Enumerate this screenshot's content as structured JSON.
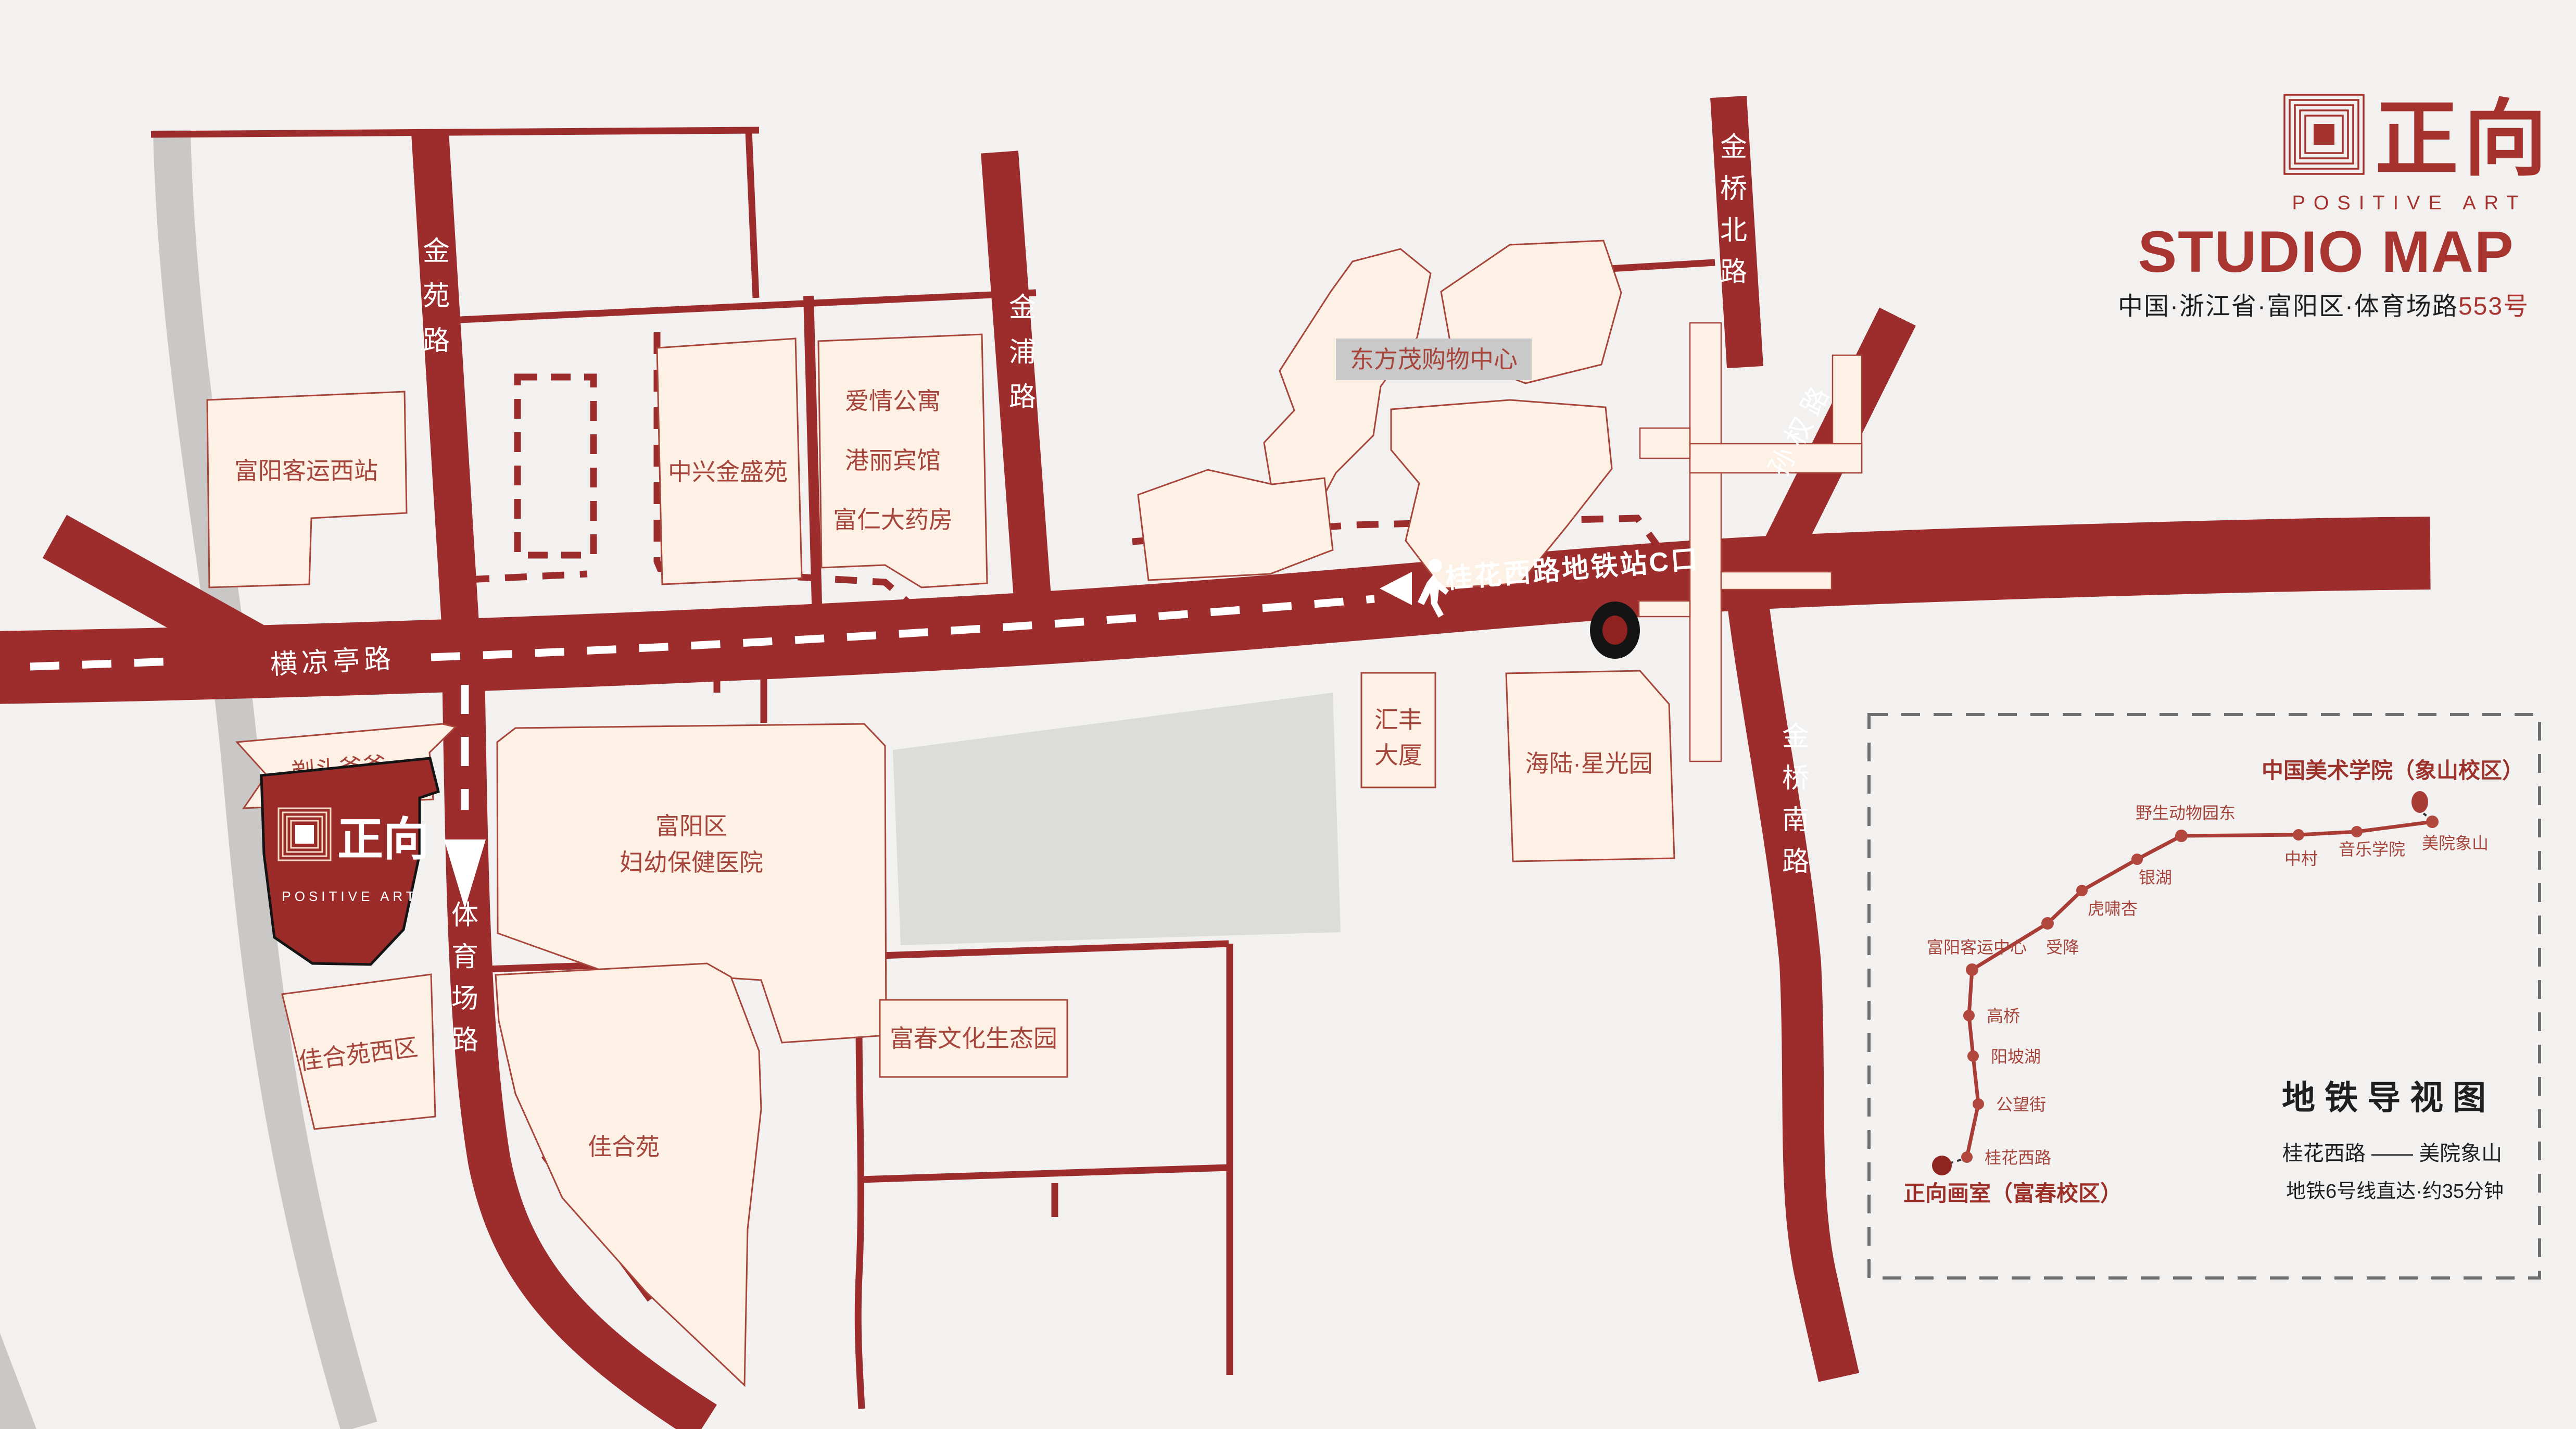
{
  "header": {
    "logo_cn": "正向",
    "logo_en": "POSITIVE ART",
    "title": "STUDIO MAP",
    "address_main": "中国·浙江省·富阳区·体育场路",
    "address_number": "553号"
  },
  "map": {
    "roads": {
      "jinyuan": "金苑路",
      "jinpu": "金浦路",
      "jinqiao_north": "金桥北路",
      "sunquan": "孙权路",
      "jinqiao_south": "金桥南路",
      "hengliangting": "横凉亭路",
      "tiyuchang": "体育场路"
    },
    "metro_exit_label": "桂花西路地铁站C口",
    "buildings": {
      "fuyang_west_station": "富阳客运西站",
      "zhongxing": "中兴金盛苑",
      "aiqing": "爱情公寓",
      "gangli": "港丽宾馆",
      "furen": "富仁大药房",
      "dongfangmao": "东方茂购物中心",
      "huifeng_l1": "汇丰",
      "huifeng_l2": "大厦",
      "hailu": "海陆·星光园",
      "hospital_l1": "富阳区",
      "hospital_l2": "妇幼保健医院",
      "titou": "剃头爸爸",
      "jiaheyuan_west": "佳合苑西区",
      "jiaheyuan": "佳合苑",
      "fuchun_park": "富春文化生态园"
    },
    "studio": {
      "cn": "正向",
      "en": "POSITIVE ART"
    }
  },
  "metro_panel": {
    "destination_title": "中国美术学院（象山校区）",
    "origin_label": "正向画室（富春校区）",
    "panel_title": "地铁导视图",
    "route": "桂花西路 —— 美院象山",
    "duration": "地铁6号线直达·约35分钟",
    "stations": [
      {
        "name": "桂花西路"
      },
      {
        "name": "公望街"
      },
      {
        "name": "阳坡湖"
      },
      {
        "name": "高桥"
      },
      {
        "name": "富阳客运中心"
      },
      {
        "name": "受降"
      },
      {
        "name": "虎啸杏"
      },
      {
        "name": "银湖"
      },
      {
        "name": "野生动物园东"
      },
      {
        "name": "中村"
      },
      {
        "name": "音乐学院"
      },
      {
        "name": "美院象山"
      }
    ]
  },
  "colors": {
    "background": "#f2f1f0",
    "road_red": "#9d2c2c",
    "building_fill": "#fdf0e5",
    "building_stroke": "#a8453a",
    "label_red": "#a6453c",
    "brand_red": "#a5322c",
    "studio_fill": "#9b2b28",
    "gray_road": "#c9c8c7",
    "gray_block": "#dcdcdb",
    "black": "#1f1f1f"
  }
}
